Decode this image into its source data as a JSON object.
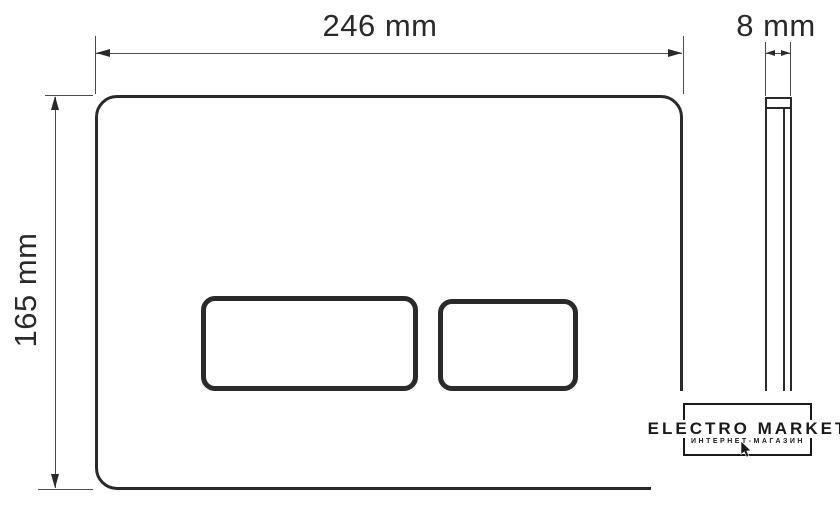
{
  "canvas": {
    "background": "#ffffff",
    "line_color": "#2b2a29",
    "dim_line_color": "#4d4b48"
  },
  "drawing": {
    "type": "technical-dimension-drawing",
    "views": [
      "front",
      "side"
    ],
    "dimensions": {
      "width": "246 mm",
      "height": "165 mm",
      "thickness": "8 mm"
    }
  },
  "watermark": {
    "brand": "ELECTRO MARKET",
    "subtitle": "ИНТЕРНЕТ-МАГАЗИН"
  }
}
